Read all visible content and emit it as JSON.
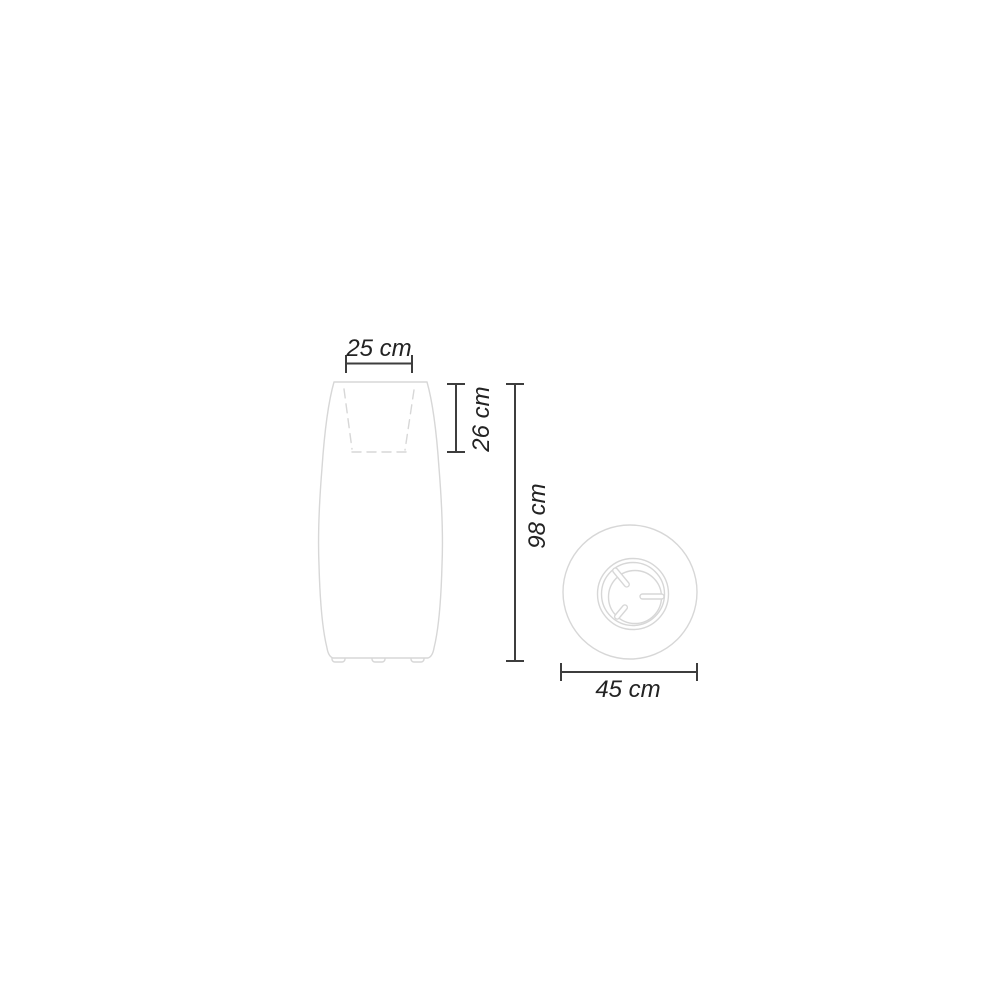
{
  "colors": {
    "background": "#ffffff",
    "product_line": "#d7d7d7",
    "dimension_line": "#3d3d3d",
    "label_text": "#232323"
  },
  "front_view": {
    "labels": {
      "top_width": "25 cm",
      "opening_depth": "26 cm",
      "height": "98 cm"
    }
  },
  "top_view": {
    "labels": {
      "diameter": "45 cm"
    }
  }
}
